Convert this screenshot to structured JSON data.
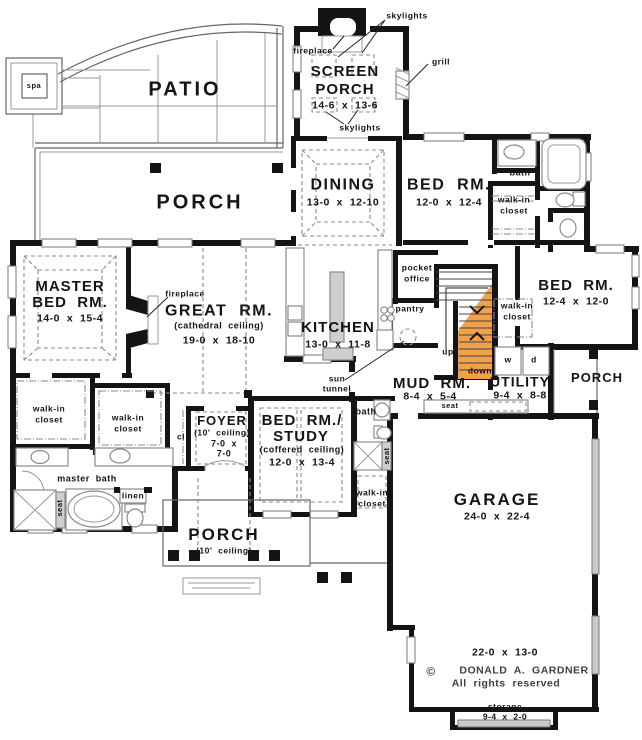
{
  "colors": {
    "wall": "#141414",
    "stair_highlight": "#F1A14C",
    "fixture_gray": "#8a8a8a",
    "garage_door_gray": "#c9c9c9"
  },
  "labels": {
    "patio": "PATIO",
    "spa": "spa",
    "skylights": "skylights",
    "fireplace": "fireplace",
    "screen_porch_1": "SCREEN",
    "screen_porch_2": "PORCH",
    "screen_porch_dims": "14-6  x  13-6",
    "grill": "grill",
    "porch": "PORCH",
    "dining": "DINING",
    "dining_dims": "13-0  x  12-10",
    "bed_top": "BED  RM.",
    "bed_top_dims": "12-0  x  12-4",
    "bath": "bath",
    "walk_in_1": "walk-in",
    "walk_in_2": "closet",
    "master_1": "MASTER",
    "master_2": "BED  RM.",
    "master_dims": "14-0  x  15-4",
    "great": "GREAT  RM.",
    "great_ceiling": "(cathedral  ceiling)",
    "great_dims": "19-0  x  18-10",
    "kitchen": "KITCHEN",
    "kitchen_dims": "13-0  x  11-8",
    "pocket_1": "pocket",
    "pocket_2": "office",
    "pantry": "pantry",
    "up": "up",
    "down": "down",
    "bed_right": "BED  RM.",
    "bed_right_dims": "12-4  x  12-0",
    "w": "w",
    "d": "d",
    "sun_1": "sun",
    "sun_2": "tunnel",
    "mud": "MUD  RM.",
    "mud_dims": "8-4  x  5-4",
    "utility": "UTILITY",
    "utility_dims": "9-4  x  8-8",
    "seat": "seat",
    "study_1": "BED  RM./",
    "study_2": "STUDY",
    "study_ceiling": "(coffered  ceiling)",
    "study_dims": "12-0  x  13-4",
    "foyer": "FOYER",
    "foyer_ceiling": "(10'  ceiling)",
    "foyer_dims_1": "7-0  x",
    "foyer_dims_2": "7-0",
    "cl": "cl",
    "master_bath": "master  bath",
    "linen": "linen",
    "porch_front_ceiling": "(10'  ceiling)",
    "garage": "GARAGE",
    "garage_dims": "24-0  x  22-4",
    "garage_ext_dims": "22-0  x  13-0",
    "copyright": "©",
    "author": "DONALD  A.  GARDNER",
    "rights": "All  rights  reserved",
    "storage": "storage",
    "storage_dims": "9-4  x  2-0"
  }
}
